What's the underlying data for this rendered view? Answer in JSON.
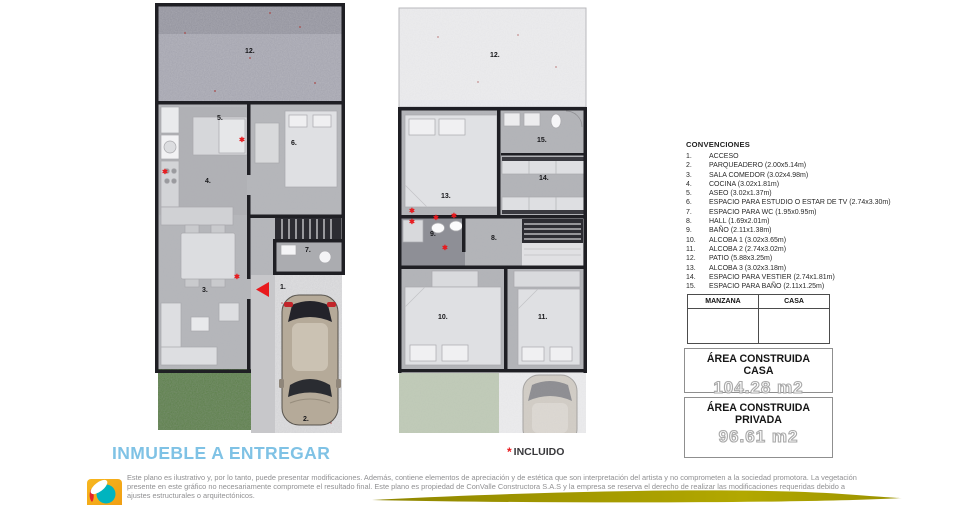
{
  "legend": {
    "title": "CONVENCIONES",
    "items": [
      {
        "num": "1.",
        "label": "ACCESO"
      },
      {
        "num": "2.",
        "label": "PARQUEADERO (2.00x5.14m)"
      },
      {
        "num": "3.",
        "label": "SALA COMEDOR (3.02x4.98m)"
      },
      {
        "num": "4.",
        "label": "COCINA (3.02x1.81m)"
      },
      {
        "num": "5.",
        "label": "ASEO (3.02x1.37m)"
      },
      {
        "num": "6.",
        "label": "ESPACIO PARA ESTUDIO O ESTAR DE TV (2.74x3.30m)"
      },
      {
        "num": "7.",
        "label": "ESPACIO PARA WC (1.95x0.95m)"
      },
      {
        "num": "8.",
        "label": "HALL (1.69x2.01m)"
      },
      {
        "num": "9.",
        "label": "BAÑO (2.11x1.38m)"
      },
      {
        "num": "10.",
        "label": "ALCOBA 1 (3.02x3.65m)"
      },
      {
        "num": "11.",
        "label": "ALCOBA 2 (2.74x3.02m)"
      },
      {
        "num": "12.",
        "label": "PATIO (5.88x3.25m)"
      },
      {
        "num": "13.",
        "label": "ALCOBA 3 (3.02x3.18m)"
      },
      {
        "num": "14.",
        "label": "ESPACIO PARA VESTIER (2.74x1.81m)"
      },
      {
        "num": "15.",
        "label": "ESPACIO PARA BAÑO (2.11x1.25m)"
      }
    ]
  },
  "table": {
    "headers": [
      "MANZANA",
      "CASA"
    ]
  },
  "area_boxes": [
    {
      "title": "ÁREA CONSTRUIDA CASA",
      "value": "104.28 m2"
    },
    {
      "title": "ÁREA CONSTRUIDA PRIVADA",
      "value": "96.61 m2"
    }
  ],
  "footer": {
    "title": "INMUEBLE A ENTREGAR",
    "included_marker": "*",
    "included_label": "INCLUIDO",
    "disclaimer": "Este plano es ilustrativo y, por lo tanto, puede presentar modificaciones. Además, contiene elementos de apreciación y de estética que son interpretación del artista y no comprometen a la sociedad promotora. La vegetación presente en este gráfico no necesariamente compromete el resultado final. Este plano es propiedad de ConValle Constructora S.A.S y la empresa se reserva el derecho de realizar las modificaciones requeridas debido a ajustes estructurales o arquitectónicos."
  },
  "markers": {
    "included_symbol": "✱"
  },
  "plans": {
    "first_floor": {
      "labels": {
        "r1": "1.",
        "r2": "2.",
        "r3": "3.",
        "r4": "4.",
        "r5": "5.",
        "r6": "6.",
        "r7": "7.",
        "r12": "12."
      }
    },
    "second_floor": {
      "labels": {
        "r8": "8.",
        "r9": "9.",
        "r10": "10.",
        "r11": "11.",
        "r12": "12.",
        "r13": "13.",
        "r14": "14.",
        "r15": "15."
      }
    }
  },
  "colors": {
    "accent_blue": "#7fc2e5",
    "marker_red": "#e8191d",
    "swoosh_olive": "#a79d00",
    "logo_orange": "#f5ac1b",
    "logo_teal": "#00b4bf",
    "logo_red": "#e5232b"
  }
}
